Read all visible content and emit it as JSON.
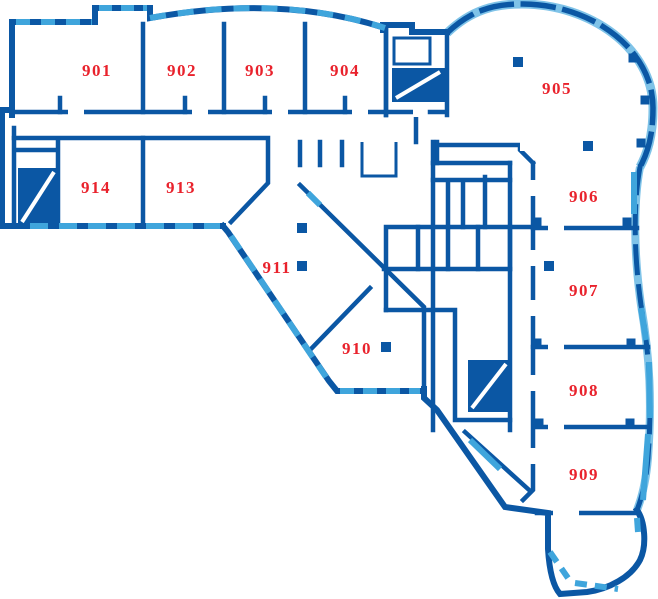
{
  "plan": {
    "name": "floor-plan-level-9",
    "rooms": [
      {
        "label": "901",
        "x": 97,
        "y": 76
      },
      {
        "label": "902",
        "x": 182,
        "y": 76
      },
      {
        "label": "903",
        "x": 260,
        "y": 76
      },
      {
        "label": "904",
        "x": 345,
        "y": 76
      },
      {
        "label": "905",
        "x": 557,
        "y": 94
      },
      {
        "label": "906",
        "x": 584,
        "y": 202
      },
      {
        "label": "907",
        "x": 584,
        "y": 296
      },
      {
        "label": "908",
        "x": 584,
        "y": 396
      },
      {
        "label": "909",
        "x": 584,
        "y": 480
      },
      {
        "label": "910",
        "x": 357,
        "y": 354
      },
      {
        "label": "911",
        "x": 277,
        "y": 273
      },
      {
        "label": "913",
        "x": 181,
        "y": 193
      },
      {
        "label": "914",
        "x": 96,
        "y": 193
      }
    ],
    "columns": [
      {
        "x": 518,
        "y": 62
      },
      {
        "x": 588,
        "y": 146
      },
      {
        "x": 549,
        "y": 266
      },
      {
        "x": 386,
        "y": 347
      },
      {
        "x": 302,
        "y": 266
      },
      {
        "x": 302,
        "y": 228
      }
    ],
    "posts": [
      {
        "x": 537,
        "y": 222
      },
      {
        "x": 627,
        "y": 222
      },
      {
        "x": 537,
        "y": 343
      },
      {
        "x": 631,
        "y": 343
      },
      {
        "x": 539,
        "y": 423
      },
      {
        "x": 630,
        "y": 423
      },
      {
        "x": 633,
        "y": 58
      },
      {
        "x": 645,
        "y": 100
      },
      {
        "x": 641,
        "y": 143
      }
    ]
  },
  "colors": {
    "wall": "#0B57A4",
    "window": "#3FA5DC",
    "pale": "#7FC3E8",
    "label": "#E9222C",
    "background": "#FFFFFF"
  }
}
